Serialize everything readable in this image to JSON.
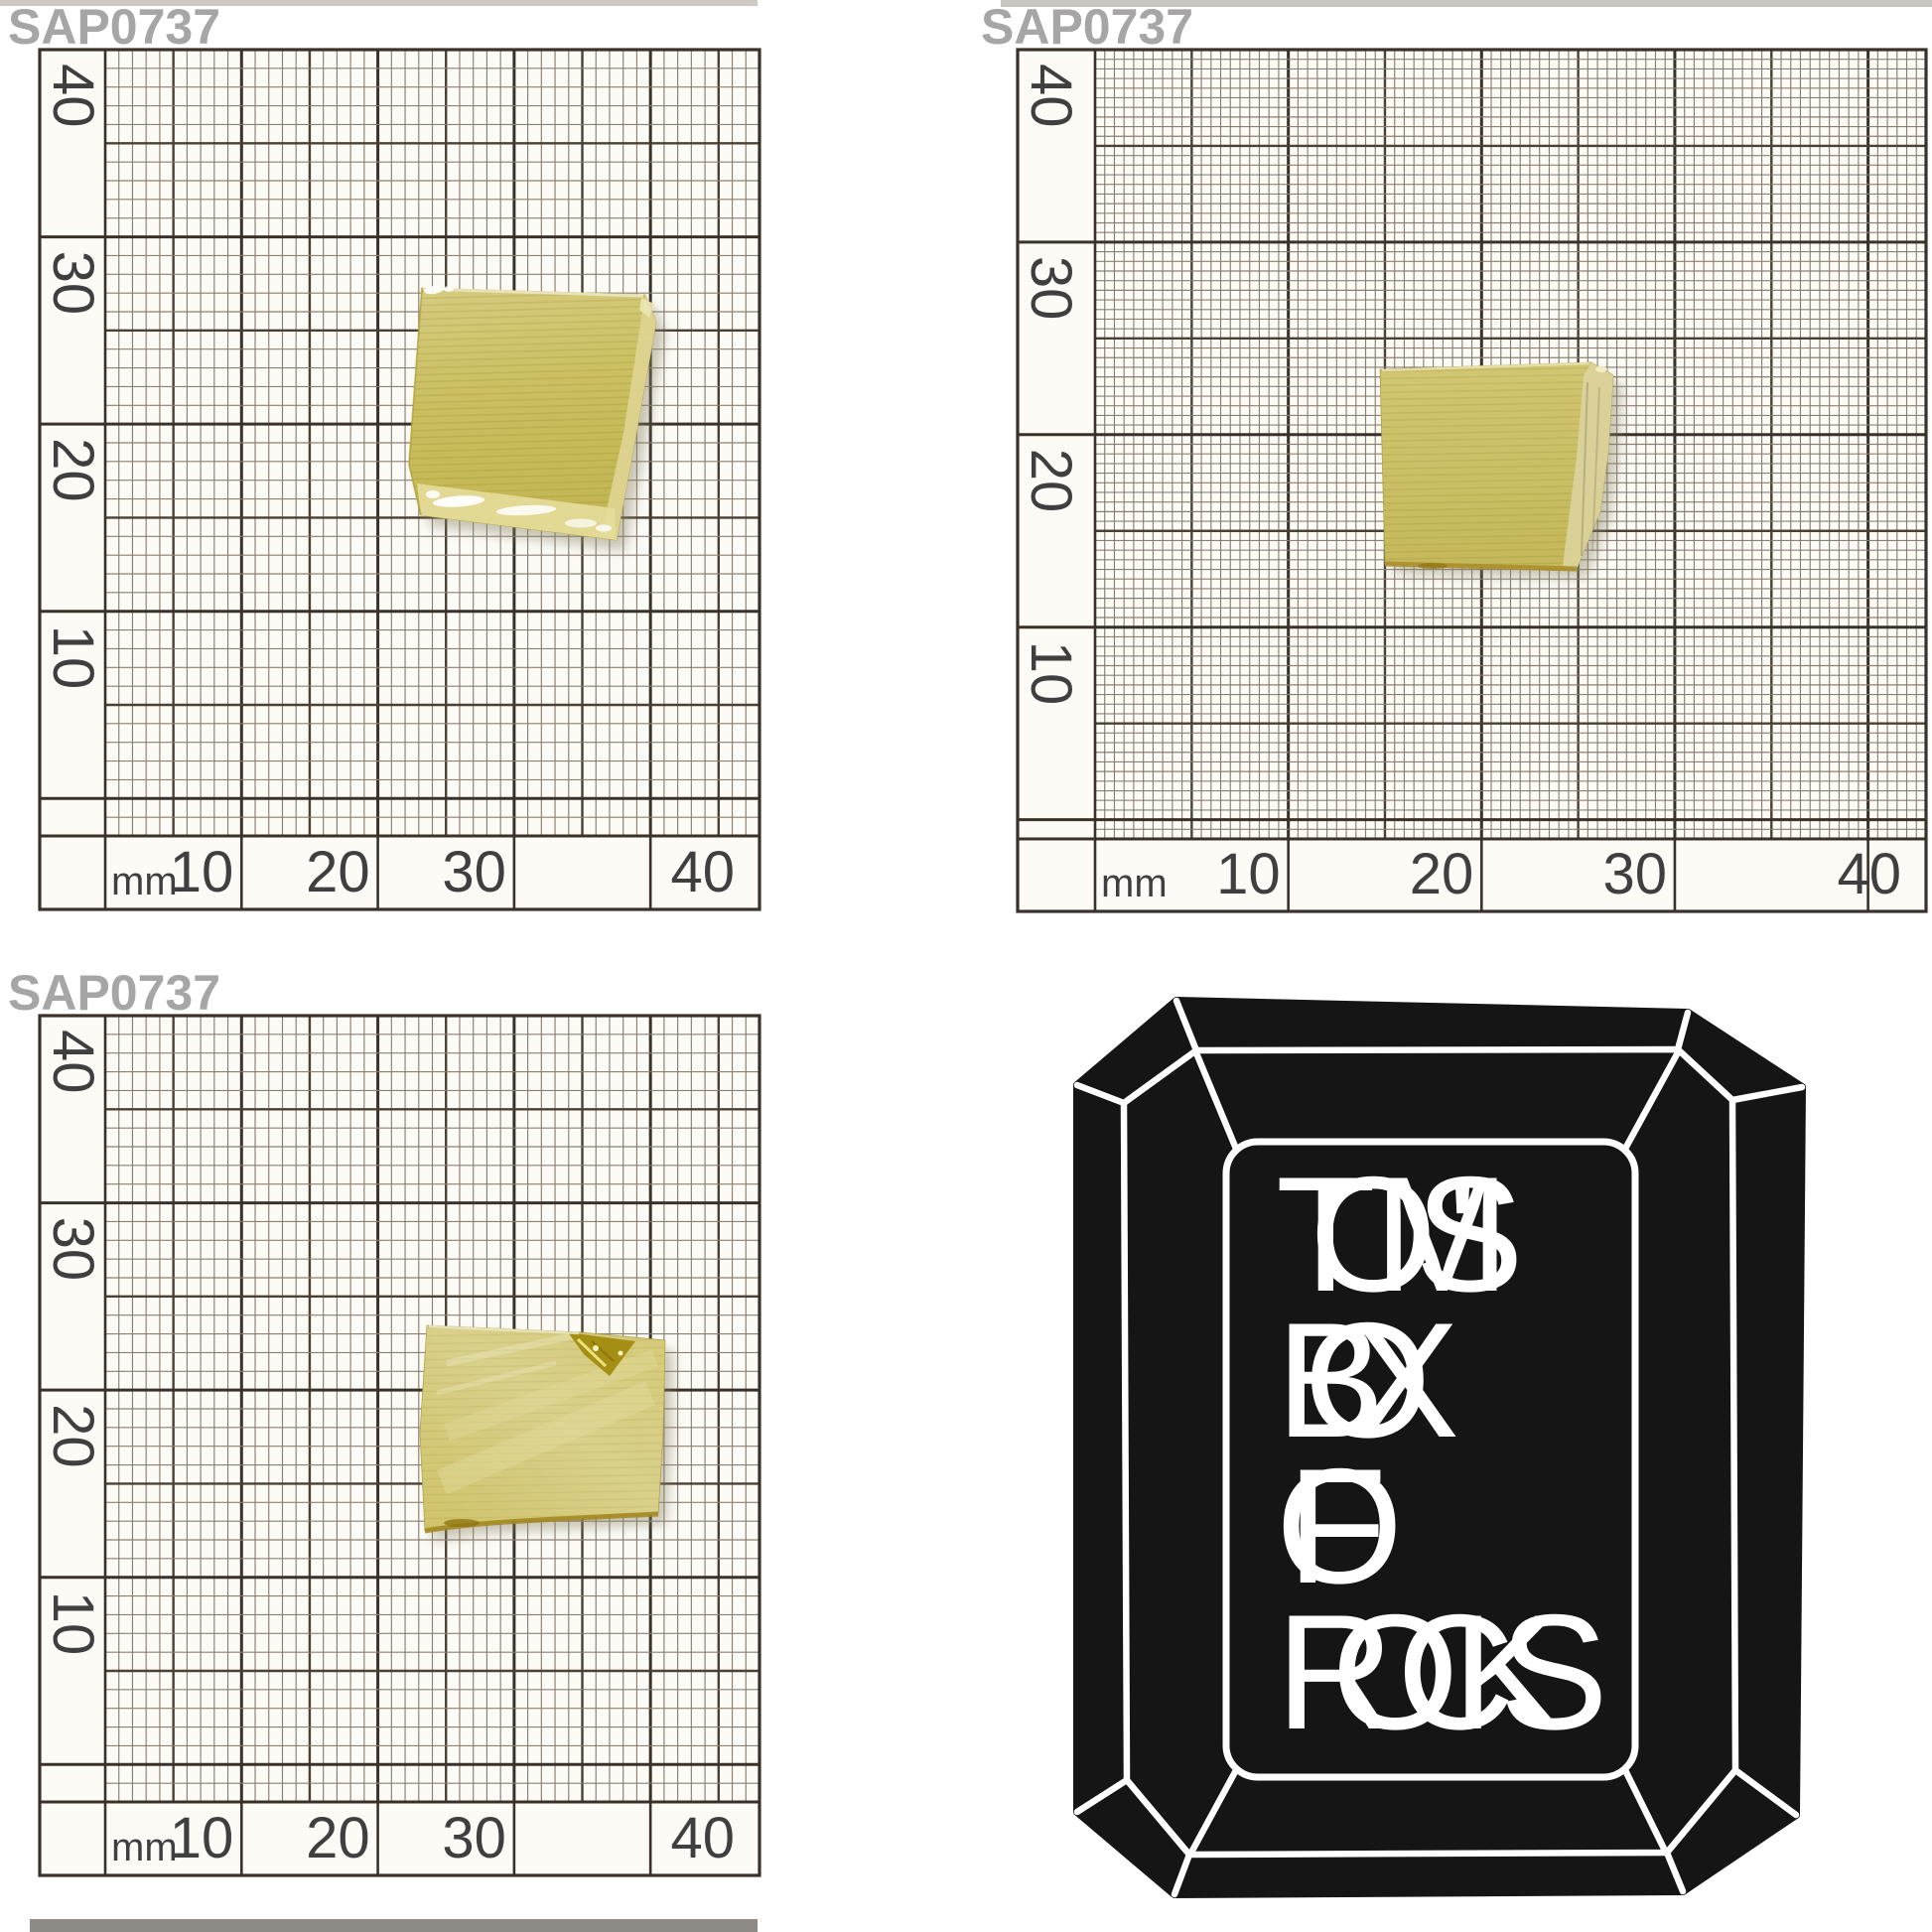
{
  "page": {
    "background": "#ffffff"
  },
  "photos": [
    {
      "view": "top",
      "specimen_label": "SAP0737"
    },
    {
      "view": "side",
      "specimen_label": "SAP0737"
    },
    {
      "view": "front",
      "specimen_label": "SAP0737"
    }
  ],
  "ruler": {
    "unit_label": "mm",
    "x_tick_labels": [
      "10",
      "20",
      "30",
      "40"
    ],
    "y_tick_labels": [
      "40",
      "30",
      "20",
      "10"
    ]
  },
  "logo": {
    "line1": "TOM'S",
    "line2": "BOX",
    "line3": "OF",
    "line4": "ROCKS"
  },
  "colors": {
    "specimen_label_gray": "#a6a6a6",
    "grid_line_dark": "#3a322a",
    "grid_line_accent": "#4a4034",
    "grid_line_fine": "#8a7f73",
    "stone_yellow": "#cdc166",
    "stone_highlight": "#e6dd9b",
    "logo_black": "#151515",
    "logo_white": "#ffffff"
  }
}
